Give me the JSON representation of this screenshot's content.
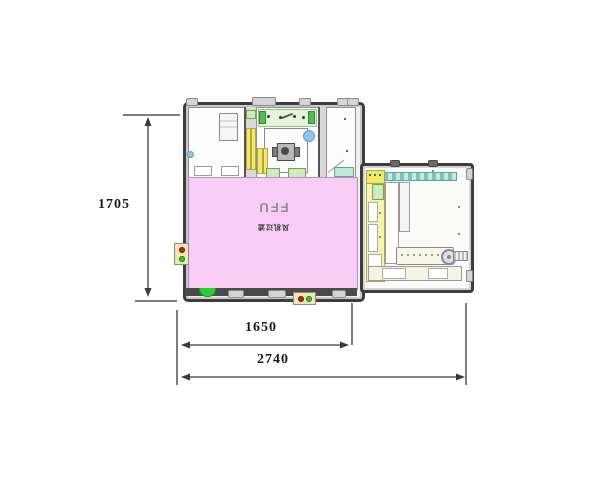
{
  "drawing": {
    "type": "equipment-top-view-layout",
    "dimensions": {
      "height": "1705",
      "inner_width": "1650",
      "total_width": "2740"
    },
    "main_unit": {
      "ffu_label": "FFU",
      "ffu_sublabel": "风机过滤"
    },
    "colors": {
      "ffu_zone_pink": "#f7cdf7",
      "frame_dark": "#3d3d3d",
      "component_yellow": "#f0e96e",
      "rail_teal": "#7cc4b6",
      "band_green": "#e7f4dc",
      "indicator_red": "#cc2020",
      "indicator_green": "#2ecc2e",
      "detail_blue": "#8ec7ea",
      "strip_ivory": "#f5f3e4"
    }
  }
}
